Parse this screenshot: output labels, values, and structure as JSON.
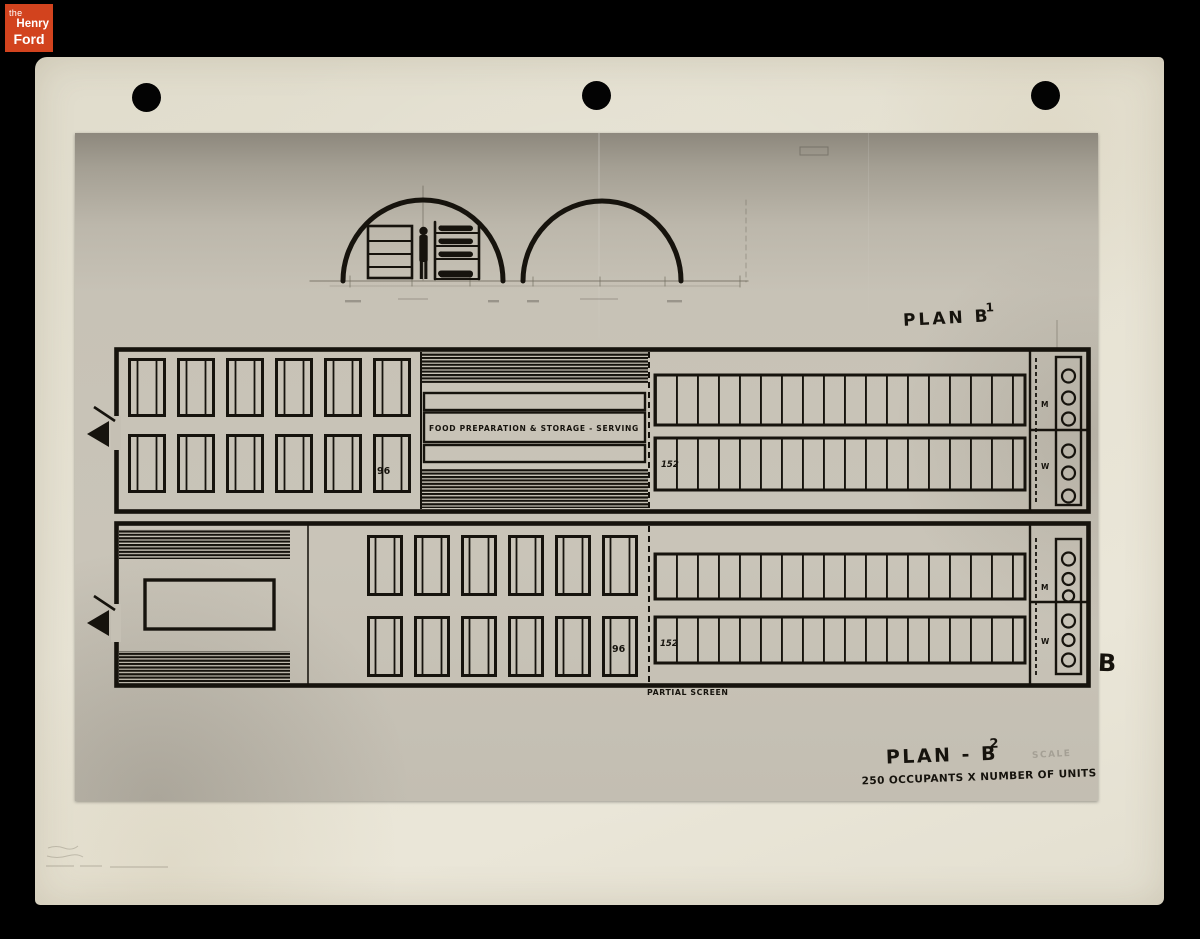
{
  "logo": {
    "the": "the",
    "henry": "Henry",
    "ford": "Ford"
  },
  "annotations": {
    "plan_b1_label": "PLAN B",
    "plan_b1_sup": "1",
    "plan_b2_label": "PLAN - B",
    "plan_b2_sup": "2",
    "plan_b2_subtitle": "250 OCCUPANTS X NUMBER OF UNITS",
    "scale_note": "SCALE",
    "food_prep_label": "FOOD PREPARATION & STORAGE - SERVING",
    "partial_screen_label": "PARTIAL SCREEN",
    "sheet_letter": "B"
  },
  "plan_b1": {
    "bunk_count_left": "96",
    "bunk_count_right": "152",
    "men_label": "M",
    "women_label": "W"
  },
  "plan_b2": {
    "bunk_count_left": "96",
    "bunk_count_right": "152",
    "men_label": "M",
    "women_label": "W"
  },
  "colors": {
    "background": "#000000",
    "logo_orange": "#d2431e",
    "paper": "#e4e0d1",
    "photo_gray": "#c7c2b6",
    "ink": "#16130d"
  }
}
